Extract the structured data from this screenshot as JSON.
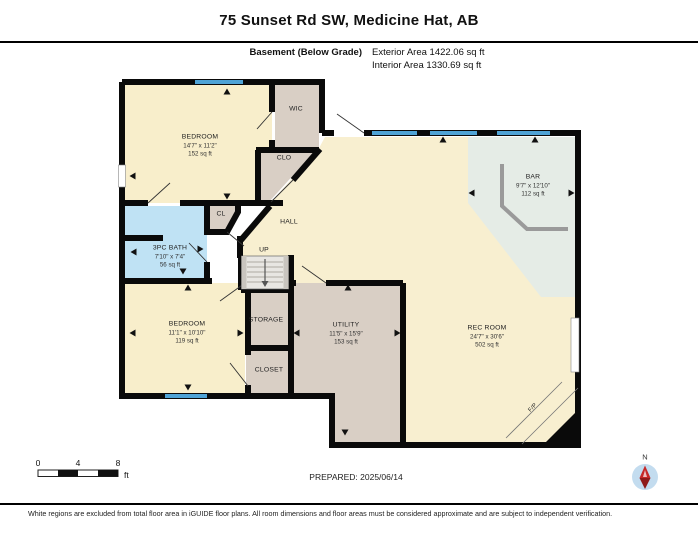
{
  "header": {
    "title": "75 Sunset Rd SW, Medicine Hat, AB",
    "floor_label": "Basement (Below Grade)",
    "exterior_area": "Exterior Area 1422.06 sq ft",
    "interior_area": "Interior Area 1330.69 sq ft"
  },
  "rooms": {
    "bedroom1": {
      "name": "BEDROOM",
      "dims": "14'7\" x 11'2\"",
      "area": "152 sq ft"
    },
    "bedroom2": {
      "name": "BEDROOM",
      "dims": "11'1\" x 10'10\"",
      "area": "119 sq ft"
    },
    "bath": {
      "name": "3PC BATH",
      "dims": "7'10\" x 7'4\"",
      "area": "56 sq ft"
    },
    "utility": {
      "name": "UTILITY",
      "dims": "11'5\" x 15'9\"",
      "area": "153 sq ft"
    },
    "rec": {
      "name": "REC ROOM",
      "dims": "24'7\" x 30'6\"",
      "area": "502 sq ft"
    },
    "bar": {
      "name": "BAR",
      "dims": "9'7\" x 12'10\"",
      "area": "112 sq ft"
    }
  },
  "labels": {
    "wic": "WIC",
    "clo": "CLO",
    "cl": "CL",
    "hall": "HALL",
    "up": "UP",
    "storage": "STORAGE",
    "closet": "CLOSET",
    "fp": "F/P"
  },
  "scale_bar": {
    "tick0": "0",
    "tick1": "4",
    "tick2": "8",
    "unit": "ft"
  },
  "prepared": "PREPARED: 2025/06/14",
  "compass": {
    "north_label": "N"
  },
  "footer": {
    "disclaimer": "White regions are excluded from total floor area in iGUIDE floor plans. All room dimensions and floor areas must be considered approximate and are subject to independent verification."
  },
  "colors": {
    "wall": "#0a0a0a",
    "room_cream": "#F8EFD0",
    "room_taupe": "#D9CFC5",
    "room_blue": "#BFE2F4",
    "room_green": "#E5ECE6",
    "window_blue": "#4FA3D6",
    "compass_red": "#C62828"
  }
}
